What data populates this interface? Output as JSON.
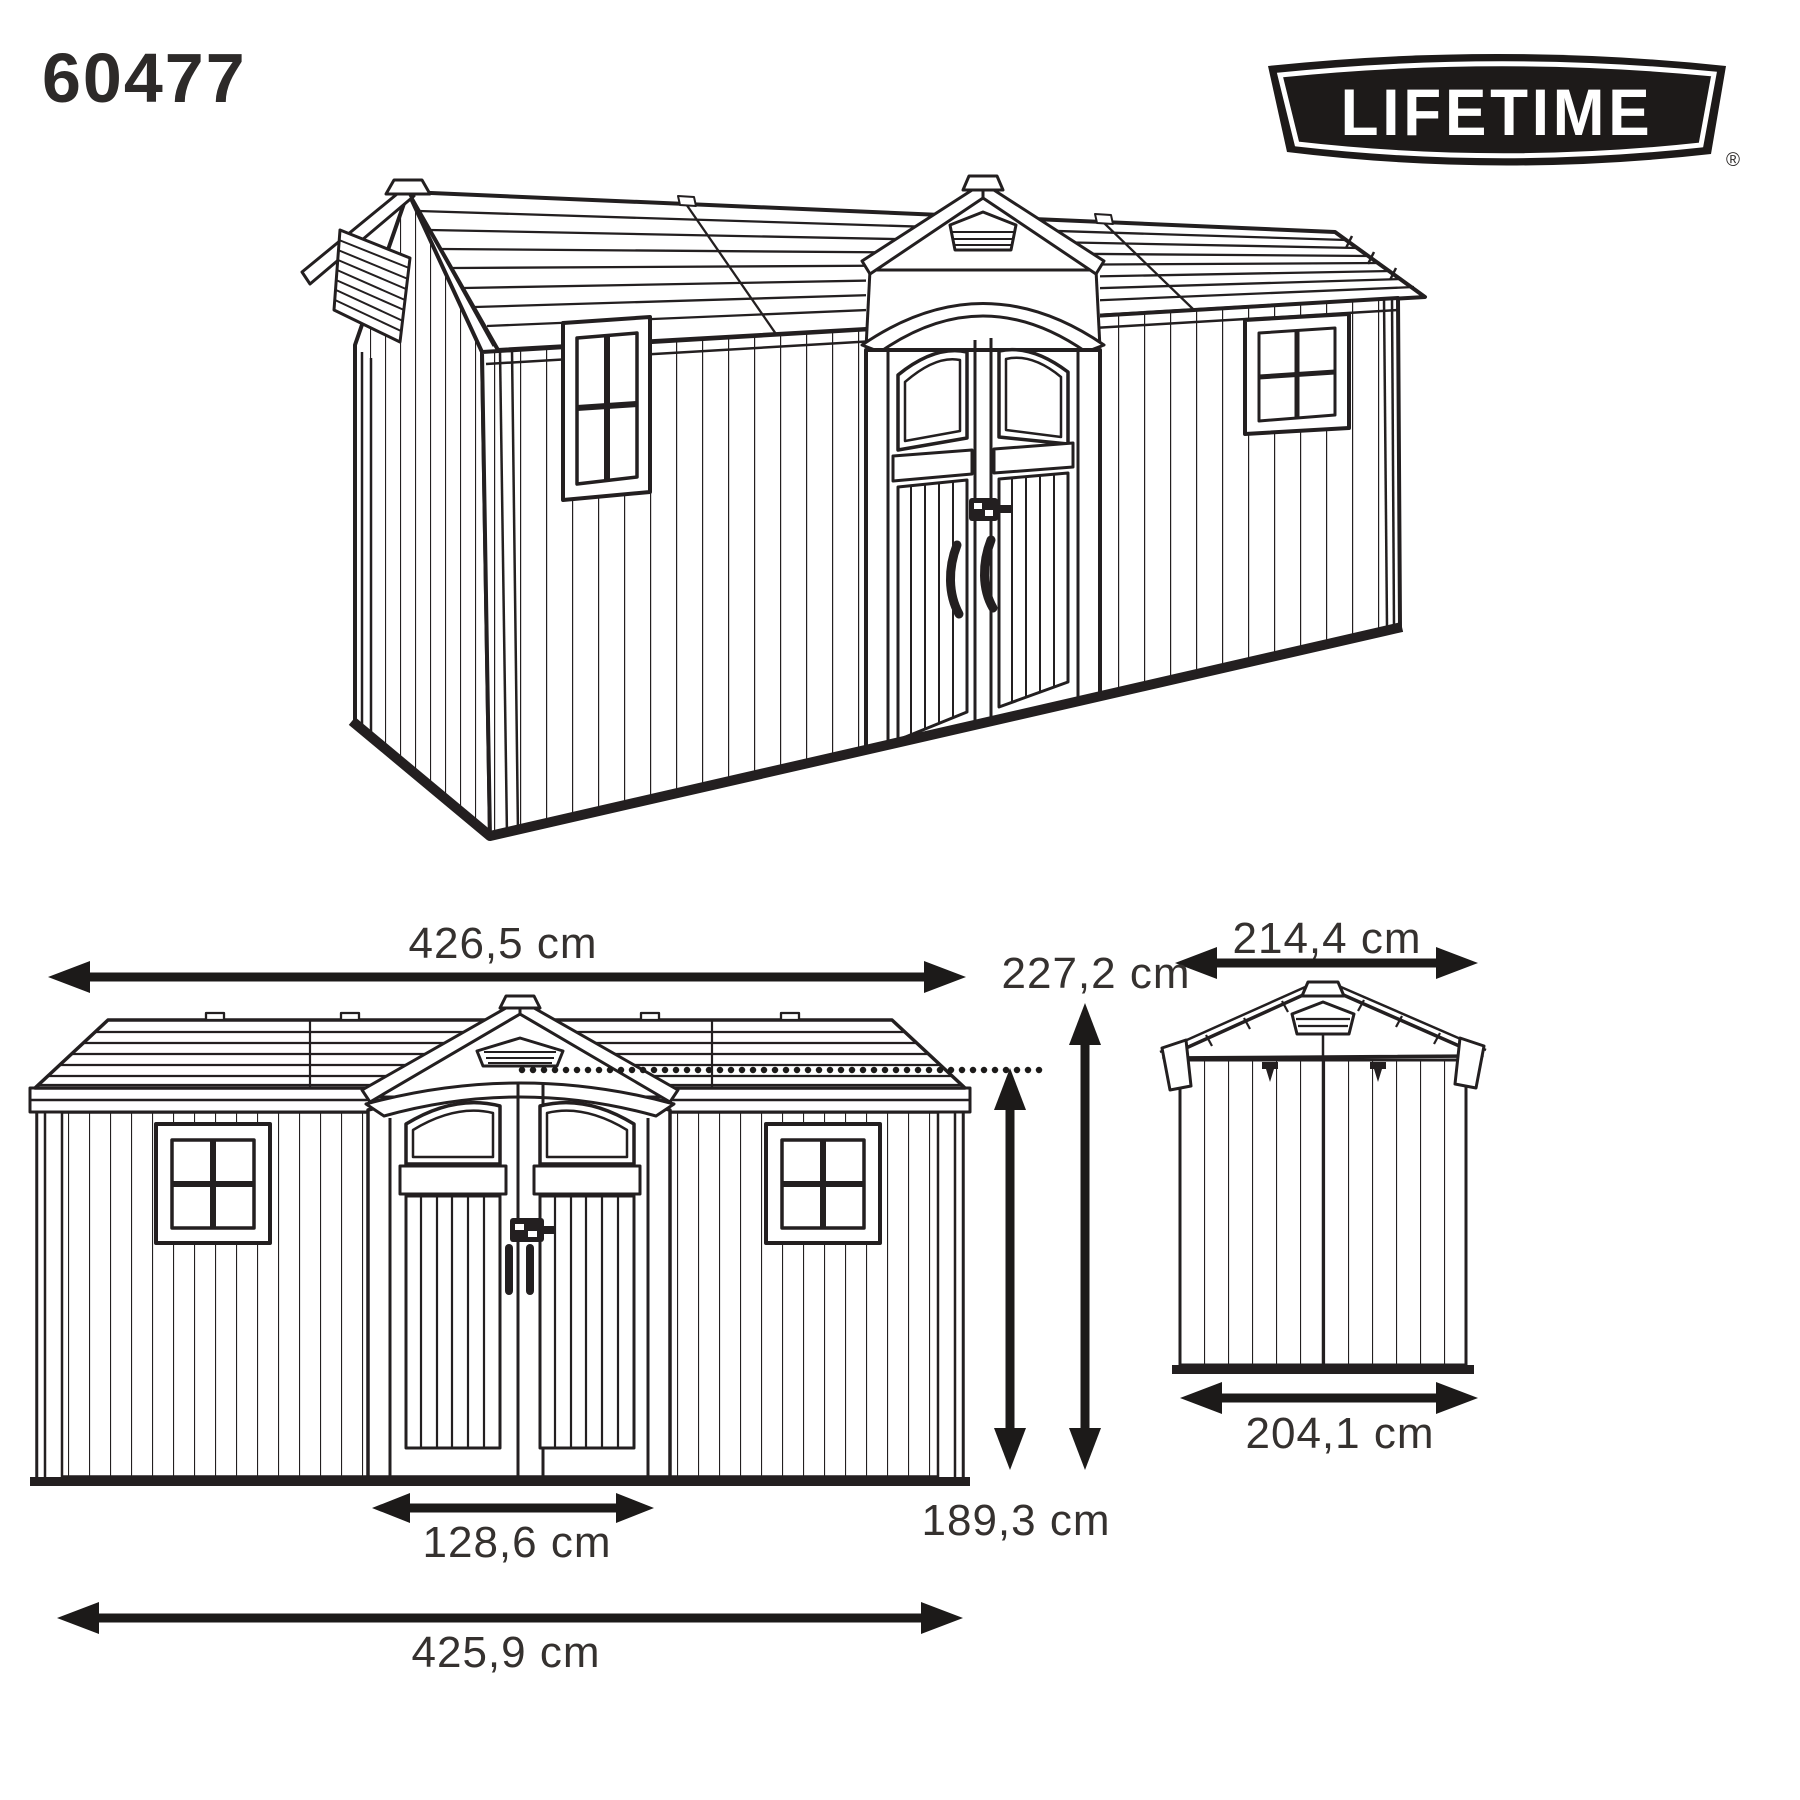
{
  "header": {
    "model_number": "60477",
    "brand": {
      "logo_text": "LIFETIME",
      "registered_mark": "®"
    }
  },
  "views": {
    "perspective": {
      "description": "3D line drawing of garden shed with double doors, two windows and gable vents"
    },
    "front_elevation": {
      "dimensions": {
        "overall_width_top": "426,5 cm",
        "overall_height": "227,2 cm",
        "eave_height": "189,3 cm",
        "door_width": "128,6 cm",
        "overall_width_bottom": "425,9 cm"
      }
    },
    "side_elevation": {
      "dimensions": {
        "roof_width": "214,4 cm",
        "base_width": "204,1 cm"
      }
    }
  },
  "colors": {
    "line": "#231f20",
    "text": "#35312f",
    "background": "#ffffff"
  }
}
